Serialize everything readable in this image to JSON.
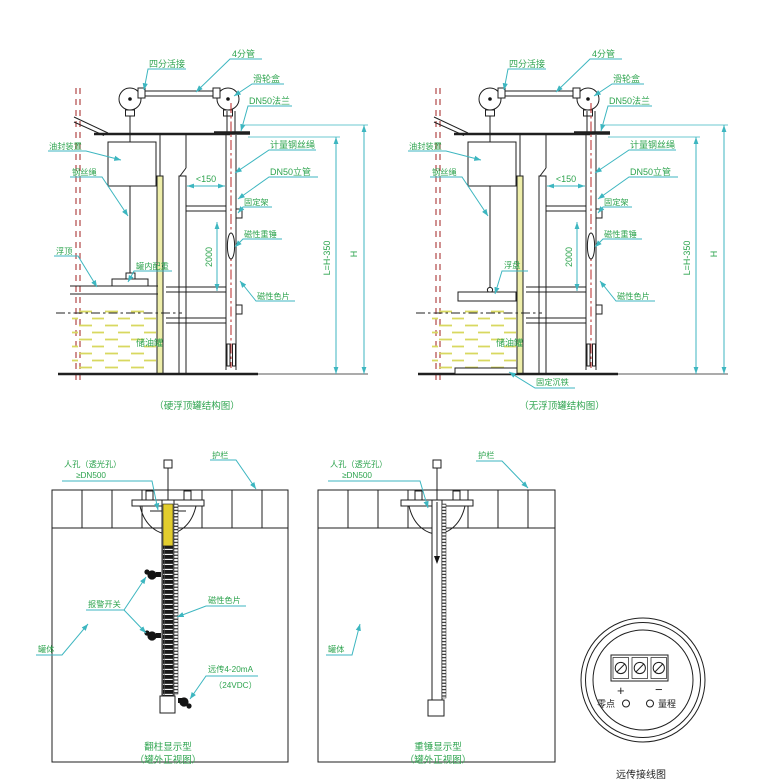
{
  "colors": {
    "label_green": "#2ea44f",
    "leader_cyan": "#3db6c0",
    "line_black": "#1f1f1f",
    "centerline_red": "#c03a3a",
    "hatch_yellow": "#d8d860",
    "gauge_yellow": "#e2cd2e"
  },
  "struct_left": {
    "labels": {
      "union": "四分活接",
      "pipe4": "4分管",
      "pulley_box": "滑轮盒",
      "flange": "DN50法兰",
      "oil_seal": "油封装置",
      "wire_rope": "钢丝绳",
      "floating_roof": "浮顶",
      "tank_weight": "罐内配重",
      "measuring_wire": "计量钢丝绳",
      "riser": "DN50立管",
      "bracket": "固定架",
      "magnetic_weight": "磁性重锤",
      "magnetic_plates": "磁性色片",
      "storage_tank": "储油罐"
    },
    "dims": {
      "gap": "<150",
      "span": "2000",
      "l": "L=H-350",
      "h": "H"
    },
    "caption": "（硬浮顶罐结构图）"
  },
  "struct_right": {
    "labels": {
      "union": "四分活接",
      "pipe4": "4分管",
      "pulley_box": "滑轮盒",
      "flange": "DN50法兰",
      "oil_seal": "油封装置",
      "wire_rope": "钢丝绳",
      "float_disc": "浮盘",
      "sinker": "固定沉铁",
      "measuring_wire": "计量钢丝绳",
      "riser": "DN50立管",
      "bracket": "固定架",
      "magnetic_weight": "磁性重锤",
      "magnetic_plates": "磁性色片",
      "storage_tank": "储油罐"
    },
    "dims": {
      "gap": "<150",
      "span": "2000",
      "l": "L=H-350",
      "h": "H"
    },
    "caption": "（无浮顶罐结构图）"
  },
  "tank_left": {
    "labels": {
      "manhole1": "人孔（透光孔）",
      "manhole2": "≥DN500",
      "guardrail": "护栏",
      "alarm": "报警开关",
      "plates": "磁性色片",
      "body": "罐体",
      "remote1": "远传4-20mA",
      "remote2": "（24VDC）"
    },
    "caption1": "翻柱显示型",
    "caption2": "（罐外正视图）"
  },
  "tank_mid": {
    "labels": {
      "manhole1": "人孔（透光孔）",
      "manhole2": "≥DN500",
      "guardrail": "护栏",
      "body": "罐体"
    },
    "caption1": "重锤显示型",
    "caption2": "（罐外正视图）"
  },
  "wiring": {
    "plus": "+",
    "minus": "−",
    "zero": "零点",
    "range": "量程",
    "caption": "远传接线图"
  }
}
